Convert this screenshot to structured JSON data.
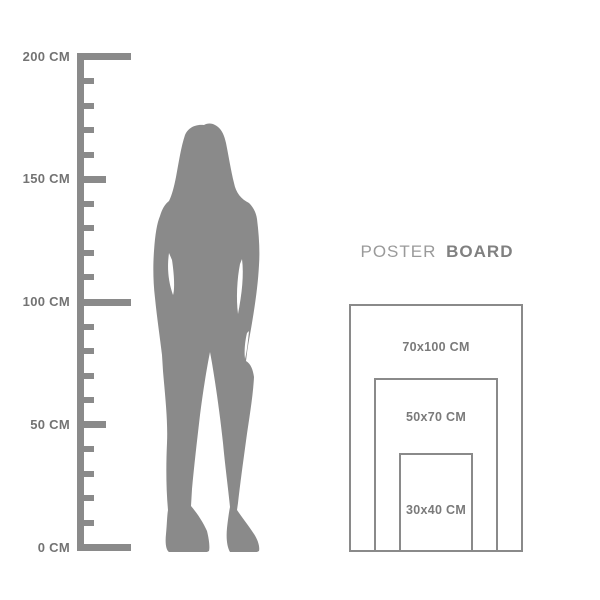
{
  "palette": {
    "silhouette_gray": "#8a8a8a",
    "ruler_gray": "#8a8a8a",
    "outline_gray": "#8a8a8a",
    "ruler_label_gray": "#737373",
    "size_label_gray": "#7a7a7a",
    "title_regular_gray": "#9a9a9a",
    "title_bold_gray": "#808080",
    "background": "#ffffff"
  },
  "ruler": {
    "unit": "CM",
    "min_cm": 0,
    "max_cm": 200,
    "minor_step_cm": 10,
    "labels": [
      {
        "value": 200,
        "text": "200 CM"
      },
      {
        "value": 150,
        "text": "150 CM"
      },
      {
        "value": 100,
        "text": "100 CM"
      },
      {
        "value": 50,
        "text": "50 CM"
      },
      {
        "value": 0,
        "text": "0 CM"
      }
    ]
  },
  "figure": {
    "type": "female-silhouette"
  },
  "poster_board": {
    "title_regular": "POSTER",
    "title_bold": "BOARD",
    "sizes": [
      {
        "label": "70x100 CM",
        "width_cm": 70,
        "height_cm": 100
      },
      {
        "label": "50x70 CM",
        "width_cm": 50,
        "height_cm": 70
      },
      {
        "label": "30x40 CM",
        "width_cm": 30,
        "height_cm": 40
      }
    ]
  }
}
